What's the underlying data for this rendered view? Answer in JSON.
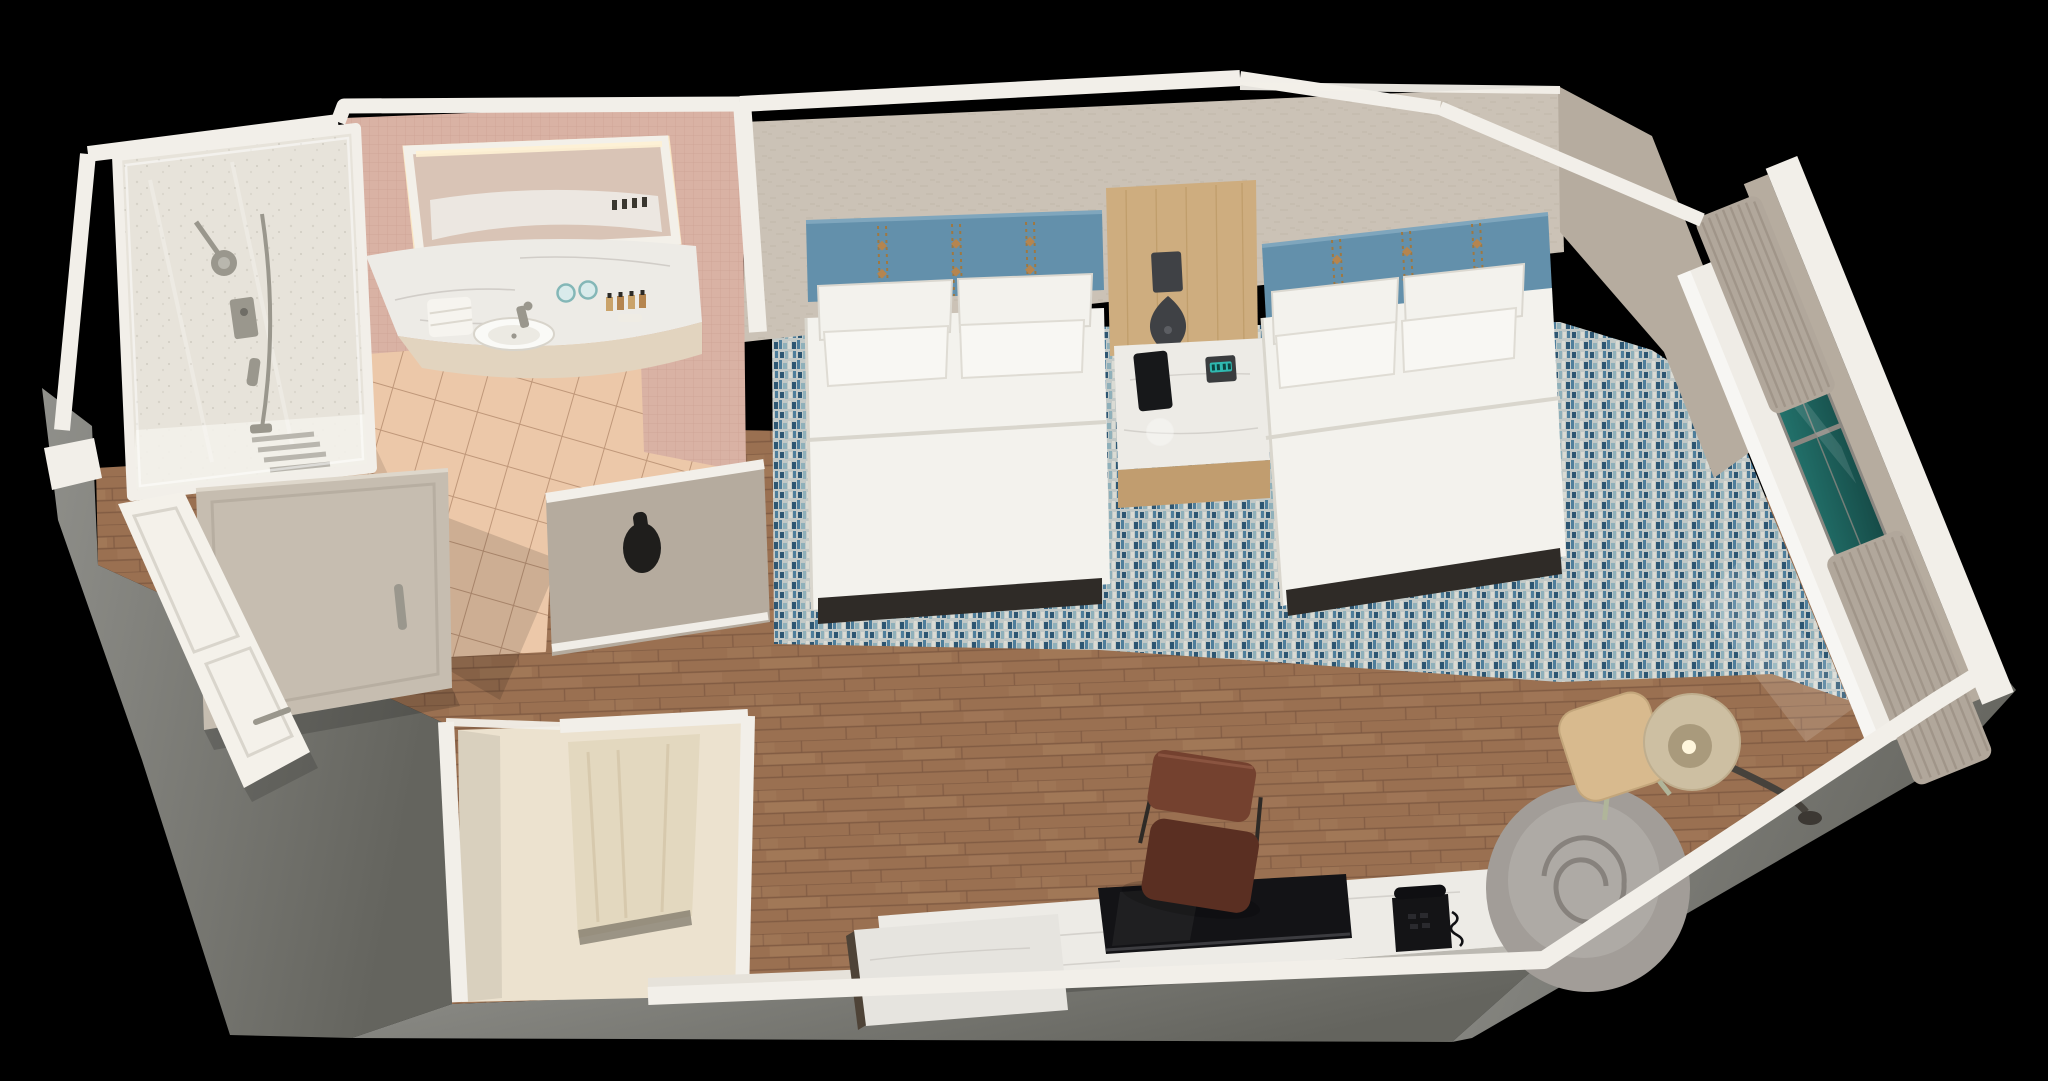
{
  "scene": {
    "title": "3D cutaway floor-plan render of a hotel guest room with two queen beds, bathroom, closet, work desk and window lounge",
    "type": "architectural-3d-floorplan-render",
    "view": "isometric birds-eye cutaway on black background"
  },
  "rooms": [
    {
      "name": "bathroom",
      "features": [
        "walk-in shower with glass enclosure",
        "rain shower head",
        "handheld shower on slide bar",
        "folding glass screen",
        "curved marble vanity with oval sink",
        "backlit mirror",
        "folded towels",
        "two drinking glasses",
        "toiletry bottles",
        "peach ceramic tile floor",
        "pink mosaic tile walls",
        "taupe door with recessed metal pull",
        "black wall pull handle"
      ]
    },
    {
      "name": "entry",
      "features": [
        "white entry door with lever handle",
        "wood plank flooring",
        "gray concrete exterior walls"
      ]
    },
    {
      "name": "closet",
      "features": [
        "open alcove",
        "cream paneled door"
      ]
    },
    {
      "name": "sleeping-area",
      "features": [
        "two queen beds with blue upholstered headboards and tan stitch details",
        "double rows of white pillows",
        "white duvets with dark bed bases",
        "light-oak headboard panel",
        "marble-top nightstand",
        "smartphone",
        "alarm clock with teal display",
        "dark teardrop pendant lamp",
        "water carafe",
        "blue abstract mosaic carpet",
        "textured beige wallpaper walls"
      ]
    },
    {
      "name": "work-lounge-area",
      "features": [
        "marble-top media console desk",
        "flat-screen television",
        "black corded desk telephone",
        "brown leather desk chair",
        "gray fabric swivel lounge chair with spiral seam",
        "light-wood side table",
        "arc floor lamp with drum shade",
        "wood plank flooring"
      ]
    },
    {
      "name": "window-bay",
      "features": [
        "floor-to-ceiling window with teal glazing",
        "gray mullions",
        "pleated taupe drapes bunched top and bottom",
        "white sill band"
      ]
    }
  ],
  "palette": {
    "bg": "#000000",
    "wall_cap": "#f2efe9",
    "wall_cap_shade": "#dcd8d0",
    "concrete": "#90908b",
    "concrete_mid": "#7c7c76",
    "concrete_dark": "#64645e",
    "wallpaper": "#cbc2b6",
    "wallpaper_tick": "#b9ae9f",
    "pink_wall": "#d9b2a4",
    "pink_grout": "#c99c8e",
    "tile": "#ecc8a9",
    "tile_grout": "#bf9779",
    "shower_floor": "#e7e3da",
    "wood": "#9a7051",
    "wood_dark": "#7b573f",
    "wood_light": "#b28a67",
    "carpet_base": "#c2c9c7",
    "carpet_blue": "#4e7e9b",
    "carpet_navy": "#2d5672",
    "carpet_teal": "#8fb0ba",
    "carpet_pale": "#dadbd4",
    "headboard": "#6390ab",
    "headboard_light": "#7fa6bd",
    "stitch": "#a2773d",
    "bedding": "#f3f2ed",
    "bedding_shade": "#d9d6cd",
    "bed_base": "#2f2b27",
    "panel_wood": "#cead7f",
    "panel_grain": "#b8955f",
    "marble": "#edebe6",
    "marble_vein": "#c9c6c0",
    "pendant": "#3f4145",
    "phone_black": "#17181a",
    "clock_teal": "#2fc7bd",
    "tv_black": "#131316",
    "leather": "#74412f",
    "leather_dark": "#5a2f22",
    "lounge_gray": "#a29d98",
    "lounge_cushion": "#aeaaa5",
    "lounge_seam": "#807b76",
    "table_wood": "#d8ba8e",
    "lamp_shade": "#cdbfa2",
    "lamp_inner": "#a99a7c",
    "lamp_arm": "#46423c",
    "glass_teal": "#257a73",
    "glass_teal_dark": "#123f3c",
    "mullion": "#8b8781",
    "curtain": "#b1a79b",
    "curtain_dark": "#968c80",
    "door_white": "#f4f1ea",
    "door_taupe": "#c6bdb0",
    "closet_cream": "#ece2cf",
    "closet_door": "#e3d8bf",
    "metal": "#9a978d",
    "face_beige": "#b6ac9f",
    "divider_face": "#b5ab9e"
  }
}
